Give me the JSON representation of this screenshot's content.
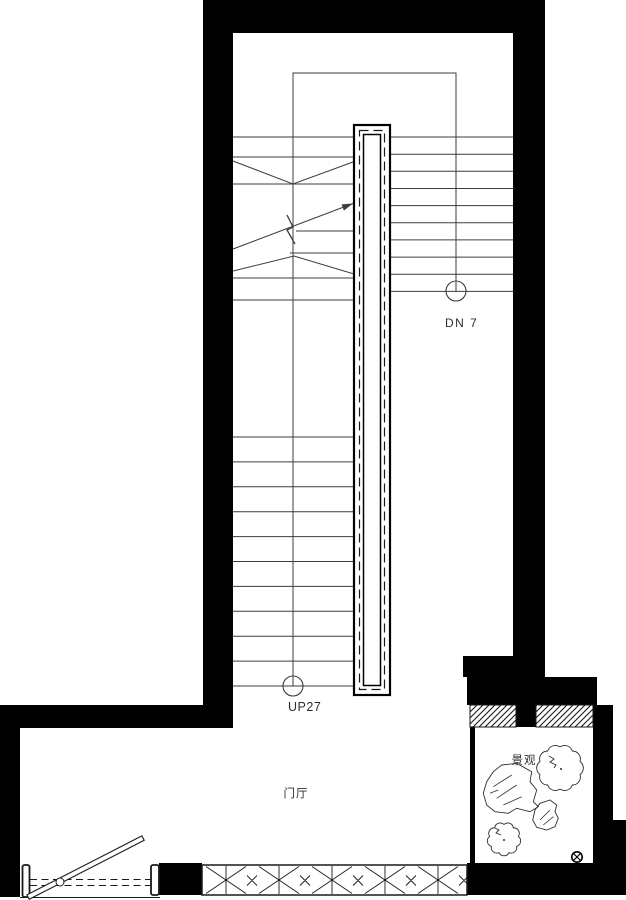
{
  "plan": {
    "labels": {
      "down_marker": "DN 7",
      "up_marker": "UP27",
      "foyer": "门厅",
      "courtyard": "景观"
    },
    "colors": {
      "wall": "#000000",
      "line": "#3d3d3d",
      "background": "#ffffff"
    }
  }
}
